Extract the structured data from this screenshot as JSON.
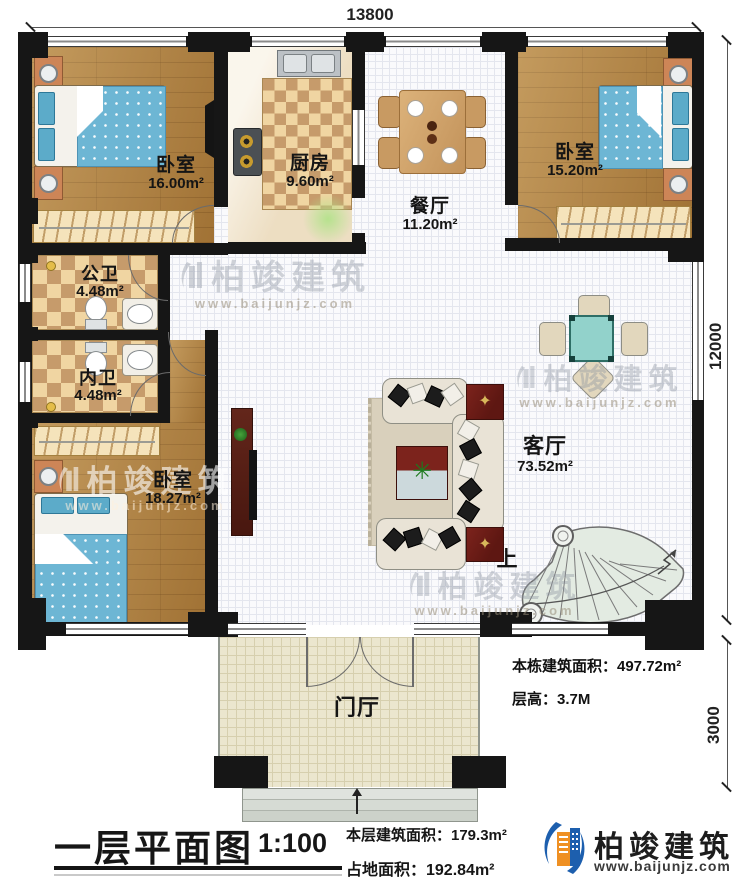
{
  "dims": {
    "width": "13800",
    "height": "12000",
    "porch_depth": "3000"
  },
  "rooms": {
    "bedroom1": {
      "name": "卧室",
      "area": "16.00m²"
    },
    "kitchen": {
      "name": "厨房",
      "area": "9.60m²"
    },
    "dining": {
      "name": "餐厅",
      "area": "11.20m²"
    },
    "bedroom2": {
      "name": "卧室",
      "area": "15.20m²"
    },
    "public_bath": {
      "name": "公卫",
      "area": "4.48m²"
    },
    "ensuite_bath": {
      "name": "内卫",
      "area": "4.48m²"
    },
    "bedroom3": {
      "name": "卧室",
      "area": "18.27m²"
    },
    "living": {
      "name": "客厅",
      "area": "73.52m²"
    },
    "foyer": {
      "name": "门厅"
    }
  },
  "annotations": {
    "up": "上",
    "total_area": "本栋建筑面积：497.72m²",
    "floor_height": "层高：3.7M"
  },
  "footer": {
    "title": "一层平面图",
    "scale": "1:100",
    "floor_area": "本层建筑面积：179.3m²",
    "land_area": "占地面积：192.84m²"
  },
  "brand": {
    "name": "柏竣建筑",
    "url": "www.baijunjz.com"
  },
  "colors": {
    "wall": "#161616",
    "wood": "#b0803e",
    "bed": "#6db6d4",
    "table_teal": "#92d2cb",
    "accent_maroon": "#7c231c",
    "logo_blue": "#1d5fae",
    "logo_orange": "#ef9023"
  }
}
